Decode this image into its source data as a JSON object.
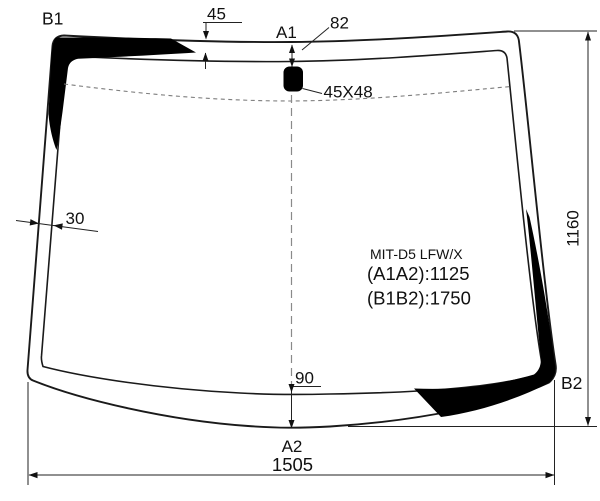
{
  "diagram": {
    "title": "Windshield glass dimensional diagram",
    "labels": {
      "b1": "B1",
      "b2": "B2",
      "a1": "A1",
      "a2": "A2"
    },
    "dimensions": {
      "top_band_depth": "45",
      "mount_offset_from_edge": "82",
      "mirror_mount_size": "45X48",
      "edge_band_width": "30",
      "glass_height": "1160",
      "bottom_center_offset": "90",
      "bottom_width": "1505"
    },
    "part": {
      "code": "MIT-D5 LFW/X",
      "a1a2_length": "(A1A2):1125",
      "b1b2_length": "(B1B2):1750"
    },
    "colors": {
      "line": "#1a1a1a",
      "frit_band": "#000000",
      "dashed_line": "#8a8a8a",
      "background": "#ffffff"
    }
  }
}
